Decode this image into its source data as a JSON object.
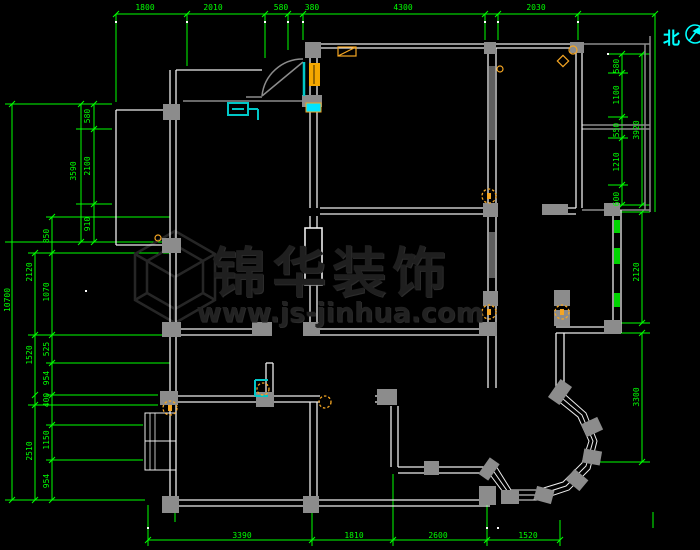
{
  "title": "CAD floor plan drawing",
  "colors": {
    "background": "#000000",
    "dimension_green": "#00ff00",
    "wall_white": "#ededed",
    "wall_gray": "#8c8c8c",
    "fixture_orange": "#f5a623",
    "fixture_cyan": "#00c8c8",
    "window_green": "#00d400",
    "watermark_gray": "#1f1f1f",
    "north_cyan": "#00ffff"
  },
  "north": {
    "label": "北",
    "icon": "north-compass-icon"
  },
  "watermark": {
    "brand": "锦华装饰",
    "website": "www.js-jinhua.com",
    "logo": "hexagon-cube-logo"
  },
  "dimensions": {
    "top": [
      {
        "label": "1800"
      },
      {
        "label": "2010"
      },
      {
        "label": "580"
      },
      {
        "label": "380"
      },
      {
        "label": "4300"
      },
      {
        "label": "2030"
      }
    ],
    "bottom": [
      {
        "label": "3390"
      },
      {
        "label": "1810"
      },
      {
        "label": "2600"
      },
      {
        "label": "1520"
      }
    ],
    "left": [
      {
        "label": "580"
      },
      {
        "label": "2100"
      },
      {
        "label": "910"
      },
      {
        "label": "3590"
      },
      {
        "label": "850"
      },
      {
        "label": "2120"
      },
      {
        "label": "1070"
      },
      {
        "label": "525"
      },
      {
        "label": "954"
      },
      {
        "label": "400"
      },
      {
        "label": "1150"
      },
      {
        "label": "954"
      },
      {
        "label": "1520"
      },
      {
        "label": "2510"
      },
      {
        "label": "10700"
      }
    ],
    "right": [
      {
        "label": "580"
      },
      {
        "label": "1100"
      },
      {
        "label": "550"
      },
      {
        "label": "1210"
      },
      {
        "label": "600"
      },
      {
        "label": "3920"
      },
      {
        "label": "2120"
      },
      {
        "label": "3300"
      }
    ]
  },
  "symbols": {
    "entry_door": "swing-door-icon",
    "ceiling_lamp": "dashed-circle-lamp-icon",
    "window": "green-window-fill",
    "column": "gray-column-block",
    "bay_window": "faceted-bay-window"
  }
}
